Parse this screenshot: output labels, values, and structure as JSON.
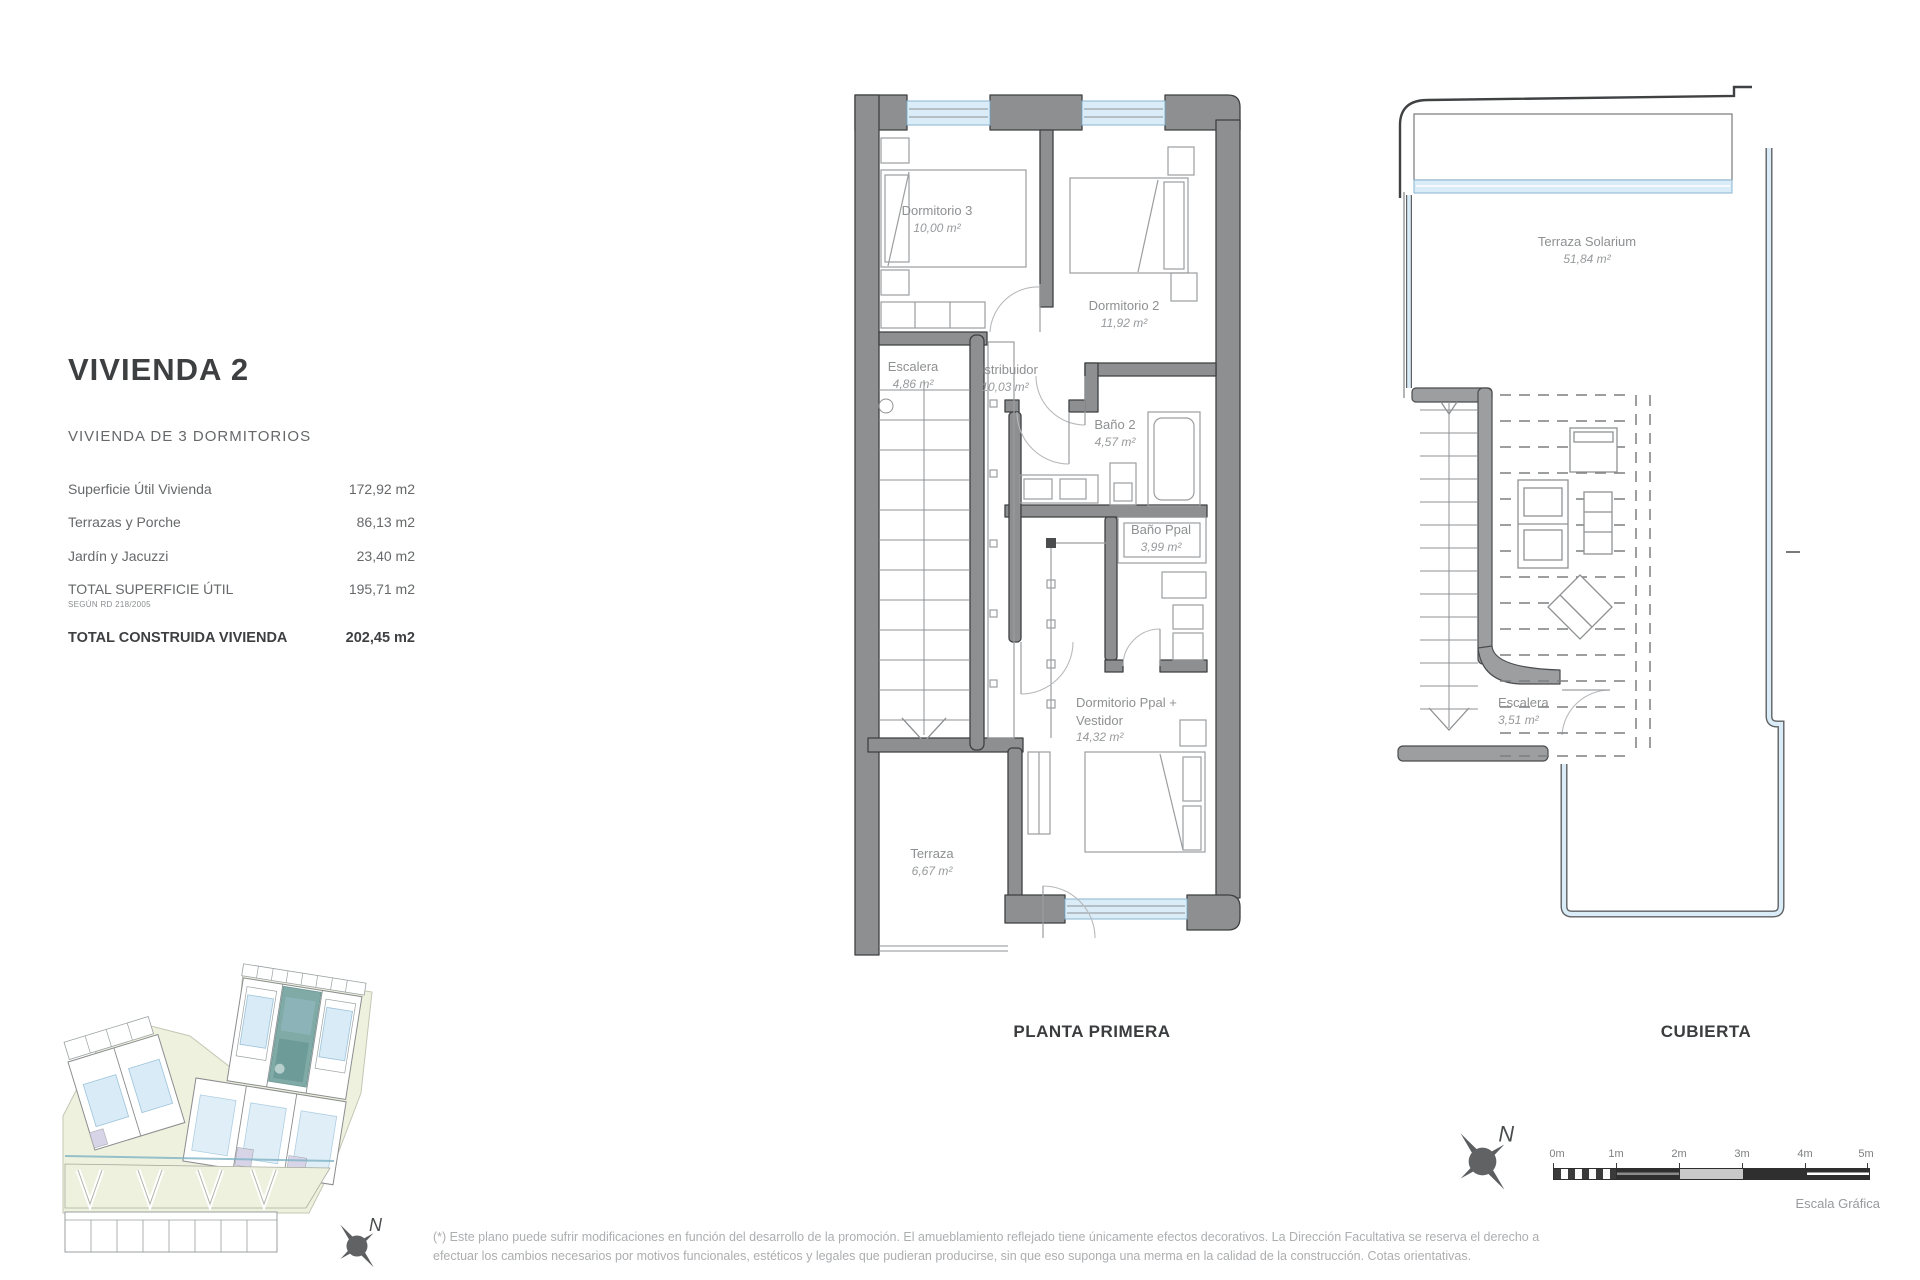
{
  "header": {
    "title": "VIVIENDA 2",
    "subtitle": "VIVIENDA DE 3 DORMITORIOS"
  },
  "summary": {
    "rows": [
      {
        "label": "Superficie Útil Vivienda",
        "value": "172,92 m2"
      },
      {
        "label": "Terrazas y Porche",
        "value": "86,13 m2"
      },
      {
        "label": "Jardín y Jacuzzi",
        "value": "23,40 m2"
      },
      {
        "label": "TOTAL SUPERFICIE ÚTIL",
        "note": "SEGÚN RD 218/2005",
        "value": "195,71 m2"
      },
      {
        "label": "TOTAL CONSTRUIDA VIVIENDA",
        "value": "202,45 m2"
      }
    ]
  },
  "planta_primera": {
    "caption": "PLANTA PRIMERA",
    "rooms": {
      "dormitorio3": {
        "name": "Dormitorio 3",
        "area": "10,00 m²"
      },
      "dormitorio2": {
        "name": "Dormitorio 2",
        "area": "11,92 m²"
      },
      "escalera": {
        "name": "Escalera",
        "area": "4,86 m²"
      },
      "distribuidor": {
        "name": "Distribuidor",
        "area": "10,03 m²"
      },
      "bano2": {
        "name": "Baño 2",
        "area": "4,57 m²"
      },
      "banoppal": {
        "name": "Baño Ppal",
        "area": "3,99 m²"
      },
      "dormppal": {
        "name": "Dormitorio Ppal + Vestidor",
        "area": "14,32 m²"
      },
      "terraza": {
        "name": "Terraza",
        "area": "6,67 m²"
      }
    }
  },
  "cubierta": {
    "caption": "CUBIERTA",
    "rooms": {
      "solarium": {
        "name": "Terraza Solarium",
        "area": "51,84 m²"
      },
      "escalera": {
        "name": "Escalera",
        "area": "3,51 m²"
      }
    }
  },
  "scale_bar": {
    "ticks": [
      "0m",
      "1m",
      "2m",
      "3m",
      "4m",
      "5m"
    ],
    "caption": "Escala Gráfica"
  },
  "compass": {
    "label": "N"
  },
  "footnote": {
    "line1": "(*) Este plano puede sufrir modificaciones en función del desarrollo de la promoción. El amueblamiento reflejado tiene únicamente efectos decorativos. La Dirección Facultativa se reserva el derecho a",
    "line2": "efectuar los cambios necesarios por motivos funcionales, estéticos y legales que pudieran producirse, sin que eso suponga una merma en la calidad de la construcción. Cotas orientativas."
  },
  "colors": {
    "wall_gray": "#8d8f91",
    "window_blue": "#d9ecf7",
    "highlight_teal": "#76a39f",
    "site_green": "#eef1de",
    "text_gray": "#8e9092",
    "title_dark": "#3d3f41"
  }
}
